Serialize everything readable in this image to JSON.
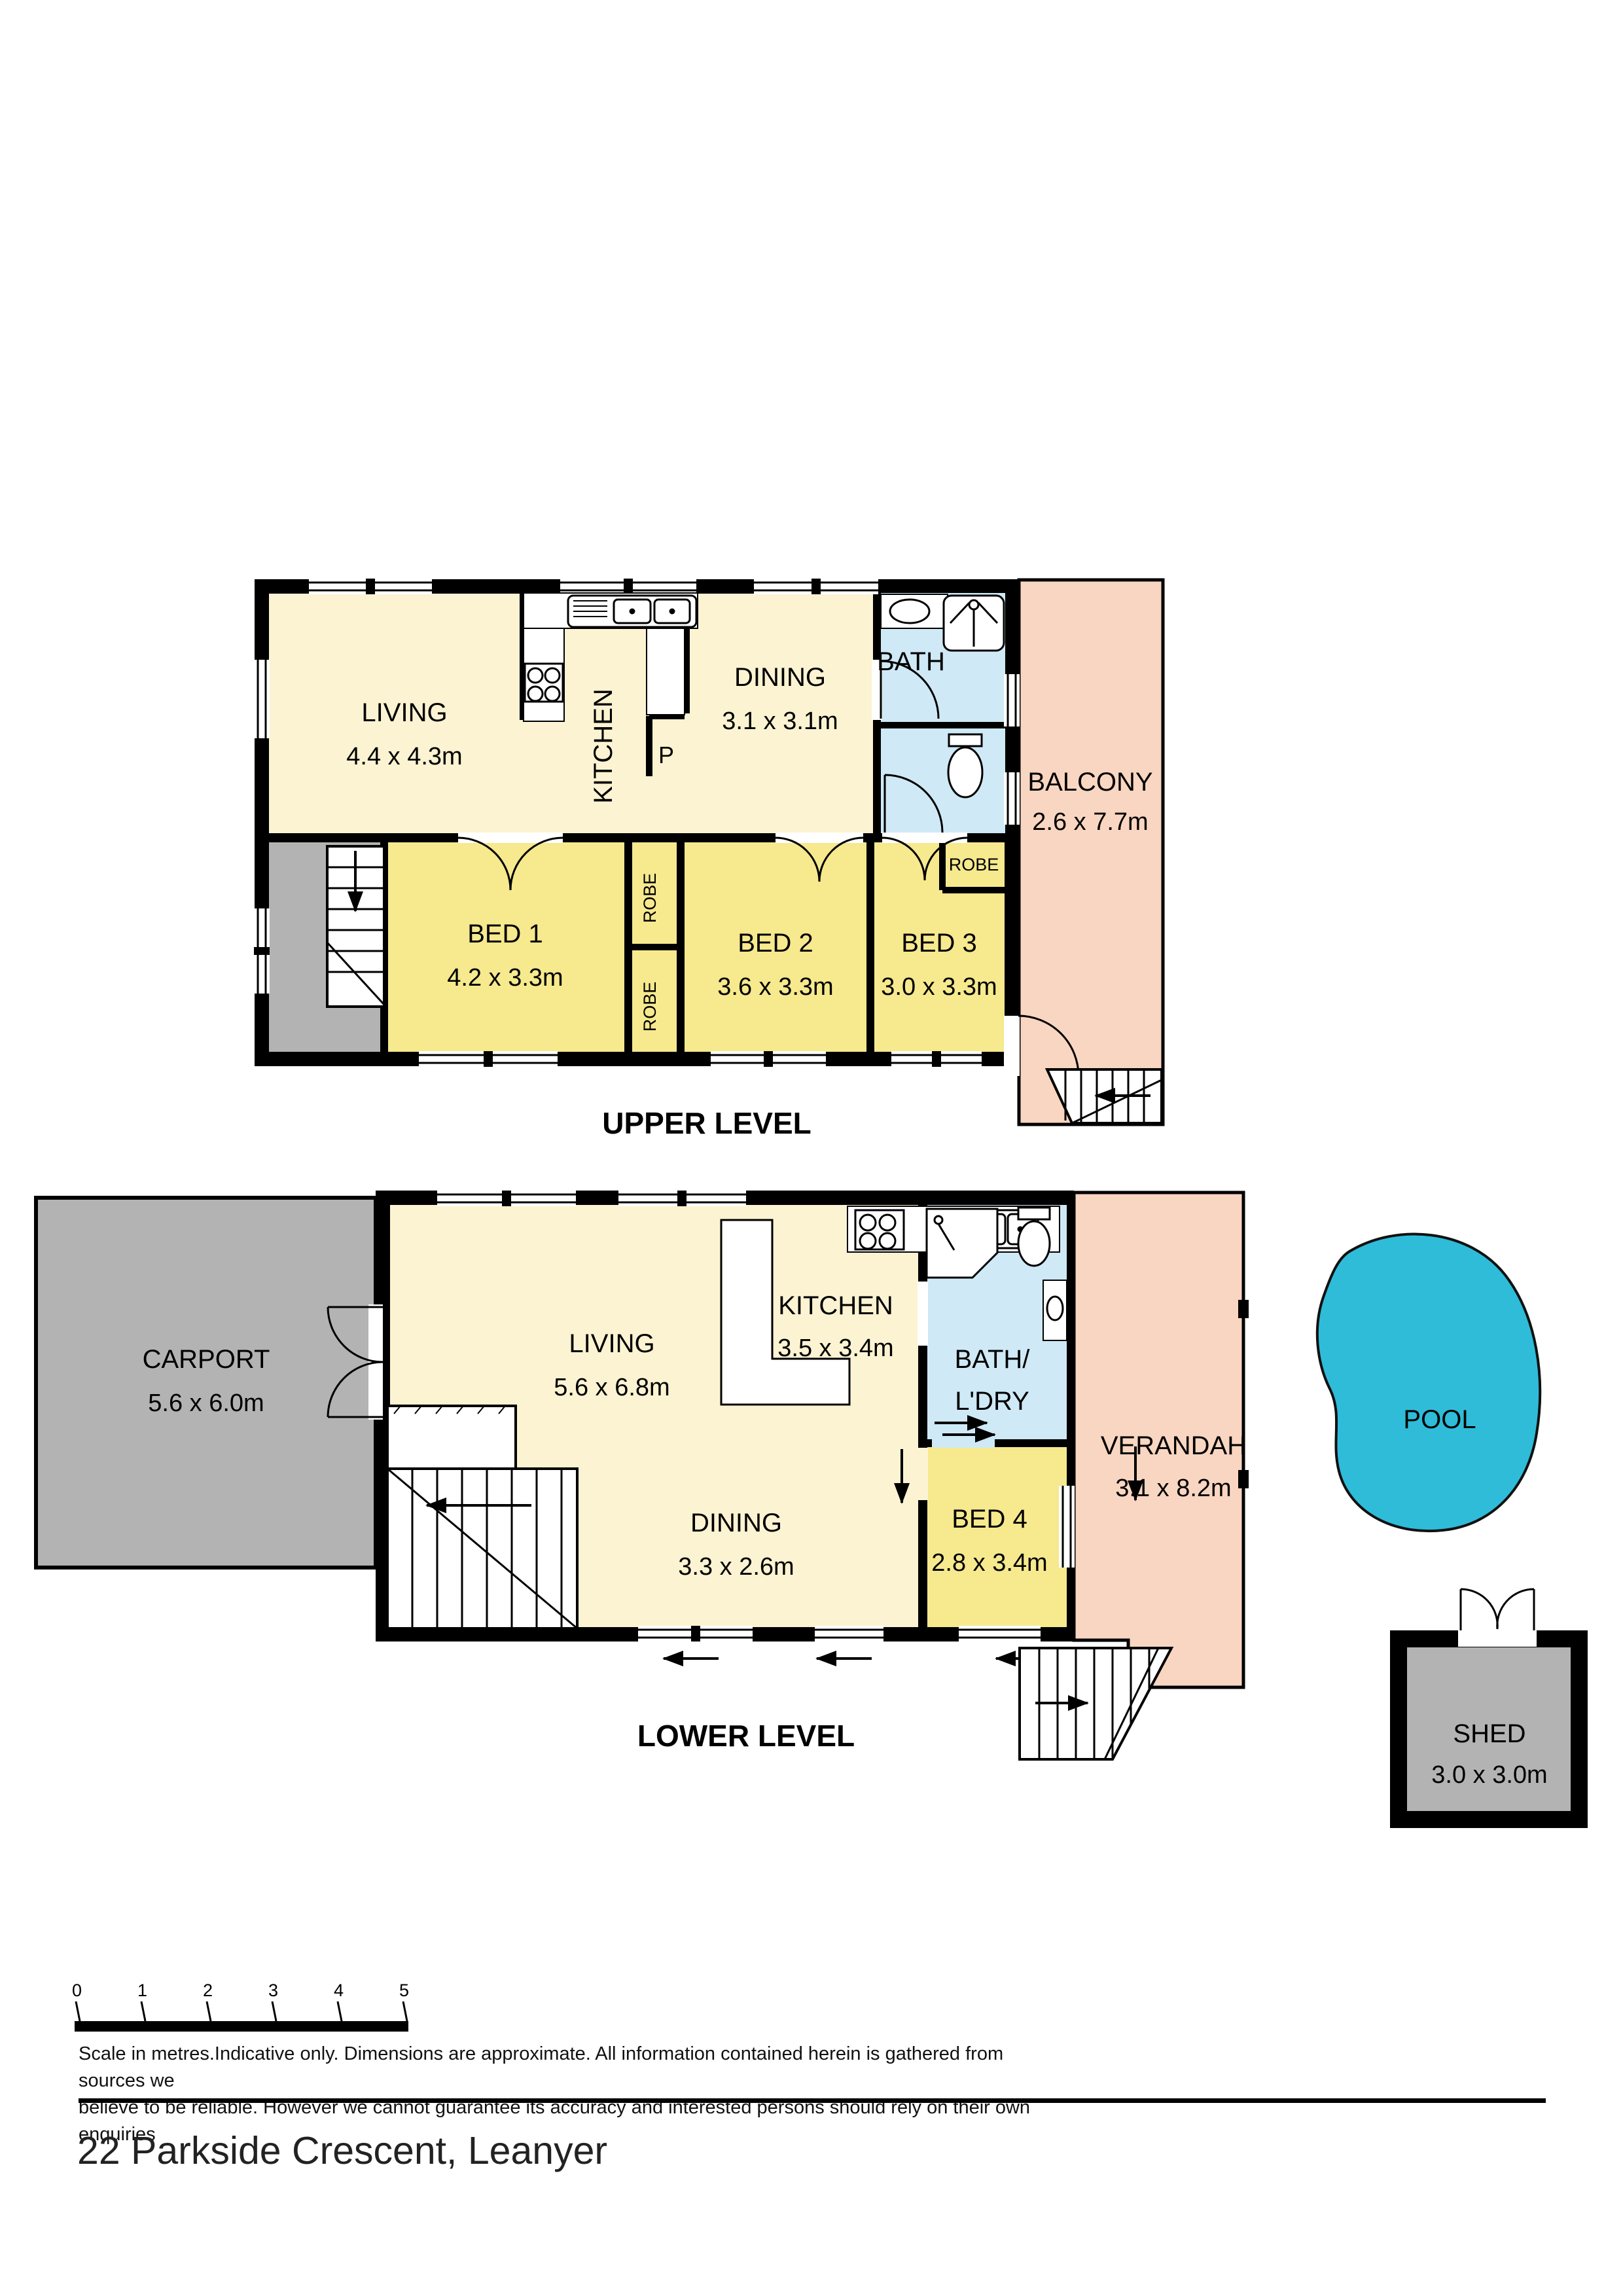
{
  "page": {
    "address": "22 Parkside Crescent, Leanyer"
  },
  "colors": {
    "floor_cream": "#FBF3D2",
    "bedroom_yellow": "#F6E98E",
    "outdoor_pink": "#F9D6C1",
    "wet_area_blue": "#CFE9F6",
    "garage_gray": "#B3B3B3",
    "pool_cyan": "#2EBCD9"
  },
  "upper": {
    "title": "UPPER LEVEL",
    "rooms": {
      "living": {
        "name": "LIVING",
        "dims": "4.4 x 4.3m"
      },
      "kitchen": {
        "name": "KITCHEN"
      },
      "pantry": {
        "name": "P"
      },
      "dining": {
        "name": "DINING",
        "dims": "3.1 x 3.1m"
      },
      "bath": {
        "name": "BATH"
      },
      "balcony": {
        "name": "BALCONY",
        "dims": "2.6 x 7.7m"
      },
      "bed1": {
        "name": "BED 1",
        "dims": "4.2 x 3.3m"
      },
      "bed2": {
        "name": "BED 2",
        "dims": "3.6 x 3.3m"
      },
      "bed3": {
        "name": "BED 3",
        "dims": "3.0 x 3.3m"
      }
    },
    "robes": [
      "ROBE",
      "ROBE",
      "ROBE"
    ]
  },
  "lower": {
    "title": "LOWER LEVEL",
    "rooms": {
      "carport": {
        "name": "CARPORT",
        "dims": "5.6 x 6.0m"
      },
      "living": {
        "name": "LIVING",
        "dims": "5.6 x 6.8m"
      },
      "kitchen": {
        "name": "KITCHEN",
        "dims": "3.5 x 3.4m"
      },
      "bath_ldry": {
        "line1": "BATH/",
        "line2": "L'DRY"
      },
      "dining": {
        "name": "DINING",
        "dims": "3.3 x 2.6m"
      },
      "bed4": {
        "name": "BED 4",
        "dims": "2.8 x 3.4m"
      },
      "verandah": {
        "name": "VERANDAH",
        "dims": "3.1 x 8.2m"
      },
      "pool": {
        "name": "POOL"
      },
      "shed": {
        "name": "SHED",
        "dims": "3.0 x 3.0m"
      }
    }
  },
  "scale_bar": {
    "ticks": [
      "0",
      "1",
      "2",
      "3",
      "4",
      "5"
    ],
    "caption_line1": "Scale in metres.Indicative only. Dimensions are approximate. All information contained herein is gathered from sources we",
    "caption_line2": "believe to be reliable. However we cannot guarantee its accuracy and interested persons should rely on their own enquiries"
  }
}
